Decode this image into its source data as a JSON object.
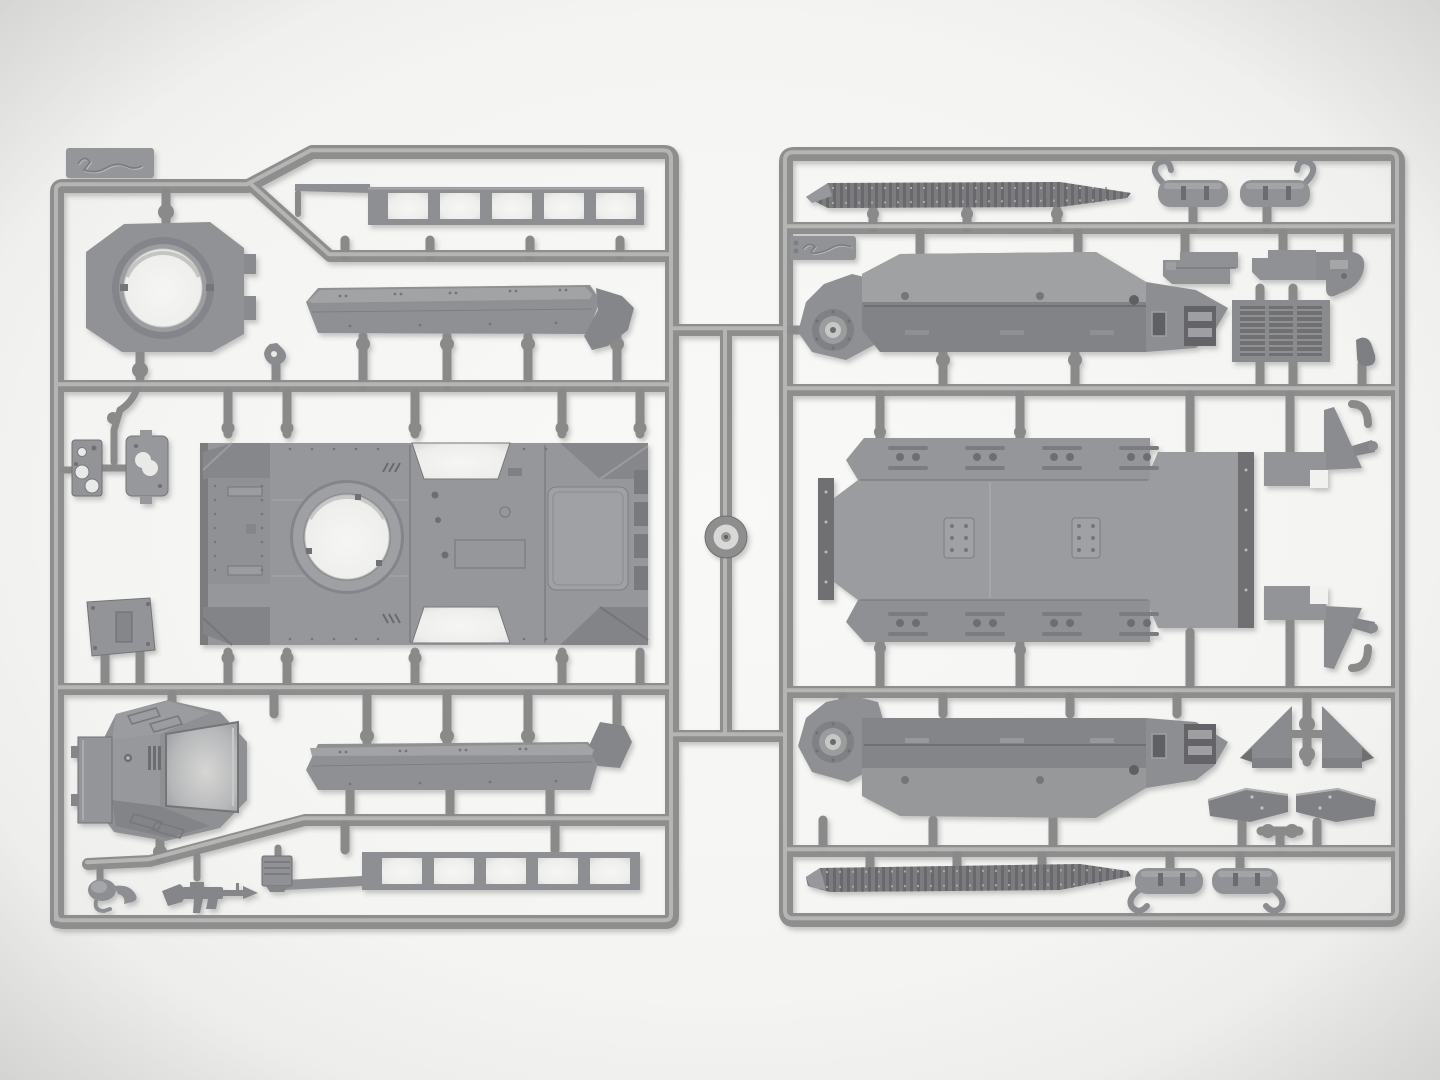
{
  "scene": {
    "description": "Photograph of two gray polystyrene injection-molded model-kit sprues with armored vehicle parts on a white lightbox",
    "left_sprue_marking": "handwritten mold scribble on tab",
    "right_sprue_marking": "handwritten mold scribble on tab"
  },
  "colors": {
    "background_center": "#f8f8f6",
    "background_edge": "#e7e7e5",
    "runner": "#8e8e8e",
    "runner_highlight": "#c2c2c0",
    "part": "#96979a",
    "part_light": "#a8a9ab",
    "part_dark": "#7e7f82",
    "track": "#7b7c7f",
    "rib": "#66676b",
    "detail_dark": "#6d6e71",
    "opening": "#f1f1ef",
    "hub_light": "#d8d8d6"
  },
  "sprues": {
    "left": {
      "parts": [
        "mold-marking-tab",
        "turret-ring-mount",
        "fender-ladder-upper",
        "hull-side-upper",
        "upper-hull-deck",
        "turret-shell",
        "turret-side-door",
        "vision-port-plate",
        "small-plate-with-holes",
        "bracket-block",
        "hull-side-lower",
        "fender-ladder-lower",
        "machine-gun",
        "headlight-bracket",
        "ribbed-box",
        "towing-hook"
      ]
    },
    "right": {
      "parts": [
        "mold-marking-tab",
        "track-run-upper",
        "muffler-front-left",
        "muffler-front-right",
        "bumper-bracket-left",
        "bumper-bracket-right",
        "hull-pontoon-upper",
        "radiator-grille",
        "hull-bottom-plate",
        "fender-tip-upper",
        "fender-tip-lower",
        "fender-support-left",
        "fender-support-right",
        "mudflap-left",
        "mudflap-right",
        "hull-pontoon-lower",
        "track-run-lower",
        "muffler-rear-left",
        "muffler-rear-right",
        "clamp-part"
      ]
    },
    "connector": {
      "hub": "sprue-hub-washer"
    }
  }
}
